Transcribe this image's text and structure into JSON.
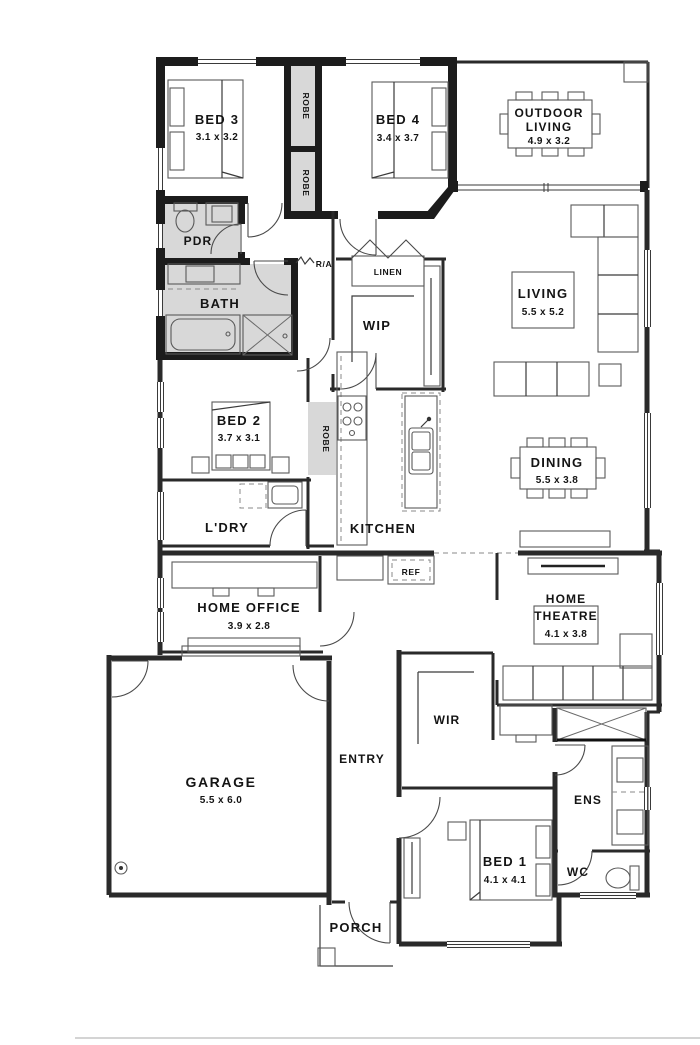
{
  "rooms": {
    "bed3": {
      "name": "BED 3",
      "dims": "3.1 x 3.2"
    },
    "bed4": {
      "name": "BED 4",
      "dims": "3.4 x 3.7"
    },
    "outdoor_living": {
      "line1": "OUTDOOR",
      "line2": "LIVING",
      "dims": "4.9 x 3.2"
    },
    "living": {
      "name": "LIVING",
      "dims": "5.5 x 5.2"
    },
    "dining": {
      "name": "DINING",
      "dims": "5.5 x 3.8"
    },
    "bed2": {
      "name": "BED 2",
      "dims": "3.7 x 3.1"
    },
    "home_office": {
      "name": "HOME OFFICE",
      "dims": "3.9 x 2.8"
    },
    "home_theatre": {
      "line1": "HOME",
      "line2": "THEATRE",
      "dims": "4.1 x 3.8"
    },
    "garage": {
      "name": "GARAGE",
      "dims": "5.5 x 6.0"
    },
    "bed1": {
      "name": "BED 1",
      "dims": "4.1 x 4.1"
    },
    "pdr": {
      "name": "PDR"
    },
    "bath": {
      "name": "BATH"
    },
    "wip": {
      "name": "WIP"
    },
    "kitchen": {
      "name": "KITCHEN"
    },
    "ldry": {
      "name": "L'DRY"
    },
    "entry": {
      "name": "ENTRY"
    },
    "wir": {
      "name": "WIR"
    },
    "ens": {
      "name": "ENS"
    },
    "wc": {
      "name": "WC"
    },
    "porch": {
      "name": "PORCH"
    },
    "linen": {
      "name": "LINEN"
    },
    "ref": {
      "name": "REF"
    },
    "ra": {
      "name": "R/A"
    },
    "robe": {
      "name": "ROBE"
    }
  },
  "colors": {
    "wall": "#1c1c1c",
    "wet_area_fill": "#d8d8d8",
    "line": "#3a3a3a",
    "background": "#ffffff"
  }
}
